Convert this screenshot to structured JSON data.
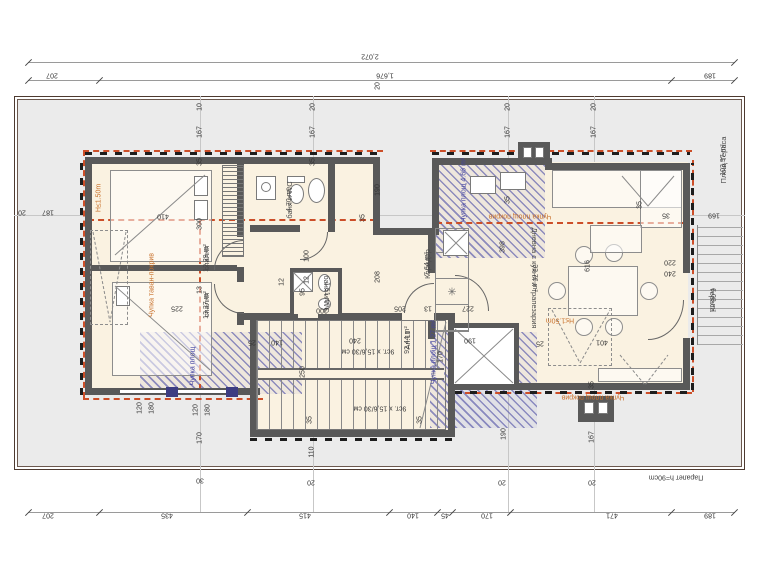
{
  "rooms": {
    "apartment": {
      "name": "Ап.11",
      "area": "92.44 m²"
    },
    "bedroom1": {
      "name": "спалня",
      "area": "12.29 m²"
    },
    "bedroom2": {
      "name": "спалня",
      "area": "13.37 m²"
    },
    "bath1": {
      "name": "баня и WC",
      "area": "4.70 m²"
    },
    "bath2": {
      "name": "баня и WC",
      "area": "1.51 m²"
    },
    "corridor": {
      "name": "Коридор",
      "area": "7.64 m²"
    },
    "living": {
      "name": "Дневна с кухня и трапезария",
      "area": "33.76 m²"
    },
    "terrace_small": {
      "name": "тераса",
      "area": "6.08 m²"
    },
    "terrace_total": {
      "name": "Площ Тераса",
      "area": "103.97 m²"
    }
  },
  "annotations": {
    "stair_flight": "9ст. x 15,6/30 см",
    "parapet": "Парапет h=90cm",
    "roof_break": "Чупка площ покрив",
    "ceiling_break": "Чупка таван-покрив",
    "height_limit": "H≤1.50m",
    "hatch_area_top": "Чупка площ 4.66 m²",
    "hatch_area_mid": "Чупка площ 1.27 m²",
    "hatch_area_left": "Чупка площ"
  },
  "dimensions": {
    "top_total": "2,072",
    "top_segments": [
      "207",
      "1,676",
      "189"
    ],
    "bottom_segments": [
      "207",
      "435",
      "415",
      "140",
      "45",
      "170",
      "471",
      "189"
    ],
    "left_segments": [
      "20",
      "187"
    ],
    "right_segments": [
      "35",
      "169"
    ]
  },
  "icons": {
    "stove": "✳"
  },
  "dim_labels": [
    {
      "t": "10",
      "x": 200,
      "y": 107,
      "r": "v"
    },
    {
      "t": "167",
      "x": 200,
      "y": 132,
      "r": "v"
    },
    {
      "t": "35",
      "x": 200,
      "y": 162,
      "r": "v"
    },
    {
      "t": "20",
      "x": 313,
      "y": 107,
      "r": "v"
    },
    {
      "t": "167",
      "x": 313,
      "y": 132,
      "r": "v"
    },
    {
      "t": "35",
      "x": 313,
      "y": 162,
      "r": "v"
    },
    {
      "t": "20",
      "x": 508,
      "y": 107,
      "r": "v"
    },
    {
      "t": "167",
      "x": 508,
      "y": 132,
      "r": "v"
    },
    {
      "t": "35",
      "x": 508,
      "y": 200,
      "r": "v"
    },
    {
      "t": "20",
      "x": 594,
      "y": 107,
      "r": "v"
    },
    {
      "t": "167",
      "x": 594,
      "y": 132,
      "r": "v"
    },
    {
      "t": "20",
      "x": 378,
      "y": 86,
      "r": "v"
    },
    {
      "t": "410",
      "x": 163,
      "y": 216,
      "r": "u"
    },
    {
      "t": "300",
      "x": 200,
      "y": 224,
      "r": "v"
    },
    {
      "t": "13",
      "x": 200,
      "y": 290,
      "r": "v"
    },
    {
      "t": "225",
      "x": 177,
      "y": 308,
      "r": "u"
    },
    {
      "t": "35",
      "x": 363,
      "y": 218,
      "r": "v"
    },
    {
      "t": "190",
      "x": 378,
      "y": 190,
      "r": "v"
    },
    {
      "t": "208",
      "x": 378,
      "y": 277,
      "r": "v"
    },
    {
      "t": "100",
      "x": 307,
      "y": 256,
      "r": "v"
    },
    {
      "t": "12",
      "x": 307,
      "y": 280,
      "r": "v"
    },
    {
      "t": "12",
      "x": 282,
      "y": 282,
      "r": "v"
    },
    {
      "t": "95",
      "x": 303,
      "y": 292,
      "r": "v"
    },
    {
      "t": "200",
      "x": 322,
      "y": 310,
      "r": "u"
    },
    {
      "t": "205",
      "x": 400,
      "y": 308,
      "r": "u"
    },
    {
      "t": "13",
      "x": 428,
      "y": 308,
      "r": "u"
    },
    {
      "t": "227",
      "x": 468,
      "y": 308,
      "r": "u"
    },
    {
      "t": "240",
      "x": 355,
      "y": 340,
      "r": "u"
    },
    {
      "t": "140",
      "x": 277,
      "y": 342,
      "r": "u"
    },
    {
      "t": "25",
      "x": 252,
      "y": 342,
      "r": "u"
    },
    {
      "t": "250",
      "x": 303,
      "y": 372,
      "r": "v"
    },
    {
      "t": "35",
      "x": 310,
      "y": 420,
      "r": "v"
    },
    {
      "t": "35",
      "x": 420,
      "y": 420,
      "r": "v"
    },
    {
      "t": "120",
      "x": 140,
      "y": 408,
      "r": "v"
    },
    {
      "t": "180",
      "x": 152,
      "y": 408,
      "r": "v"
    },
    {
      "t": "120",
      "x": 196,
      "y": 410,
      "r": "v"
    },
    {
      "t": "180",
      "x": 208,
      "y": 410,
      "r": "v"
    },
    {
      "t": "170",
      "x": 200,
      "y": 438,
      "r": "v"
    },
    {
      "t": "30",
      "x": 200,
      "y": 480,
      "r": "u"
    },
    {
      "t": "110",
      "x": 312,
      "y": 452,
      "r": "v"
    },
    {
      "t": "20",
      "x": 311,
      "y": 482,
      "r": "u"
    },
    {
      "t": "190",
      "x": 470,
      "y": 340,
      "r": "u"
    },
    {
      "t": "170",
      "x": 441,
      "y": 357,
      "r": "v"
    },
    {
      "t": "190",
      "x": 504,
      "y": 434,
      "r": "v"
    },
    {
      "t": "167",
      "x": 592,
      "y": 437,
      "r": "v"
    },
    {
      "t": "20",
      "x": 502,
      "y": 482,
      "r": "u"
    },
    {
      "t": "20",
      "x": 592,
      "y": 482,
      "r": "u"
    },
    {
      "t": "398",
      "x": 503,
      "y": 247,
      "r": "v"
    },
    {
      "t": "616",
      "x": 588,
      "y": 266,
      "r": "v"
    },
    {
      "t": "401",
      "x": 602,
      "y": 342,
      "r": "u"
    },
    {
      "t": "25",
      "x": 540,
      "y": 343,
      "r": "u"
    },
    {
      "t": "220",
      "x": 670,
      "y": 262,
      "r": "u"
    },
    {
      "t": "240",
      "x": 670,
      "y": 273,
      "r": "u"
    },
    {
      "t": "35",
      "x": 640,
      "y": 205,
      "r": "v"
    },
    {
      "t": "35",
      "x": 592,
      "y": 385,
      "r": "v"
    },
    {
      "t": "20",
      "x": 22,
      "y": 212,
      "r": "u"
    },
    {
      "t": "187",
      "x": 48,
      "y": 212,
      "r": "u"
    },
    {
      "t": "35",
      "x": 666,
      "y": 215,
      "r": "u"
    },
    {
      "t": "169",
      "x": 714,
      "y": 215,
      "r": "u"
    }
  ],
  "colors": {
    "wall": "#595959",
    "floor": "#faf2e1",
    "terrace": "#ebebeb",
    "hatch": "#6868b0",
    "roofline": "#cc4e28",
    "orange": "#c8702a",
    "blue": "#4444a0"
  }
}
